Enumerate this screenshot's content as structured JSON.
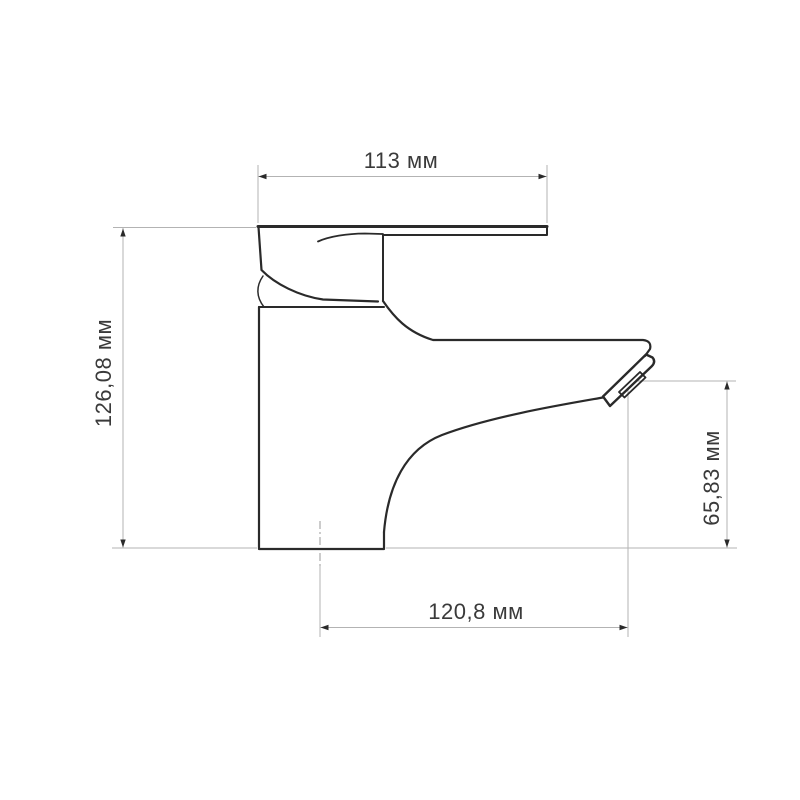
{
  "colors": {
    "background": "#ffffff",
    "product_outline": "#2a2a2a",
    "dimension_lines": "#b3b3b3",
    "dimension_text": "#3a3a3a"
  },
  "drawing": {
    "kind": "technical-dimension-drawing",
    "subject": "single-lever-basin-faucet-side-view",
    "units": "мм",
    "dimensions": {
      "top_width": {
        "label": "113 мм",
        "value": 113
      },
      "left_total_height": {
        "label": "126,08 мм",
        "value": 126.08
      },
      "right_spout_height": {
        "label": "65,83 мм",
        "value": 65.83
      },
      "bottom_depth": {
        "label": "120,8 мм",
        "value": 120.8
      }
    }
  }
}
